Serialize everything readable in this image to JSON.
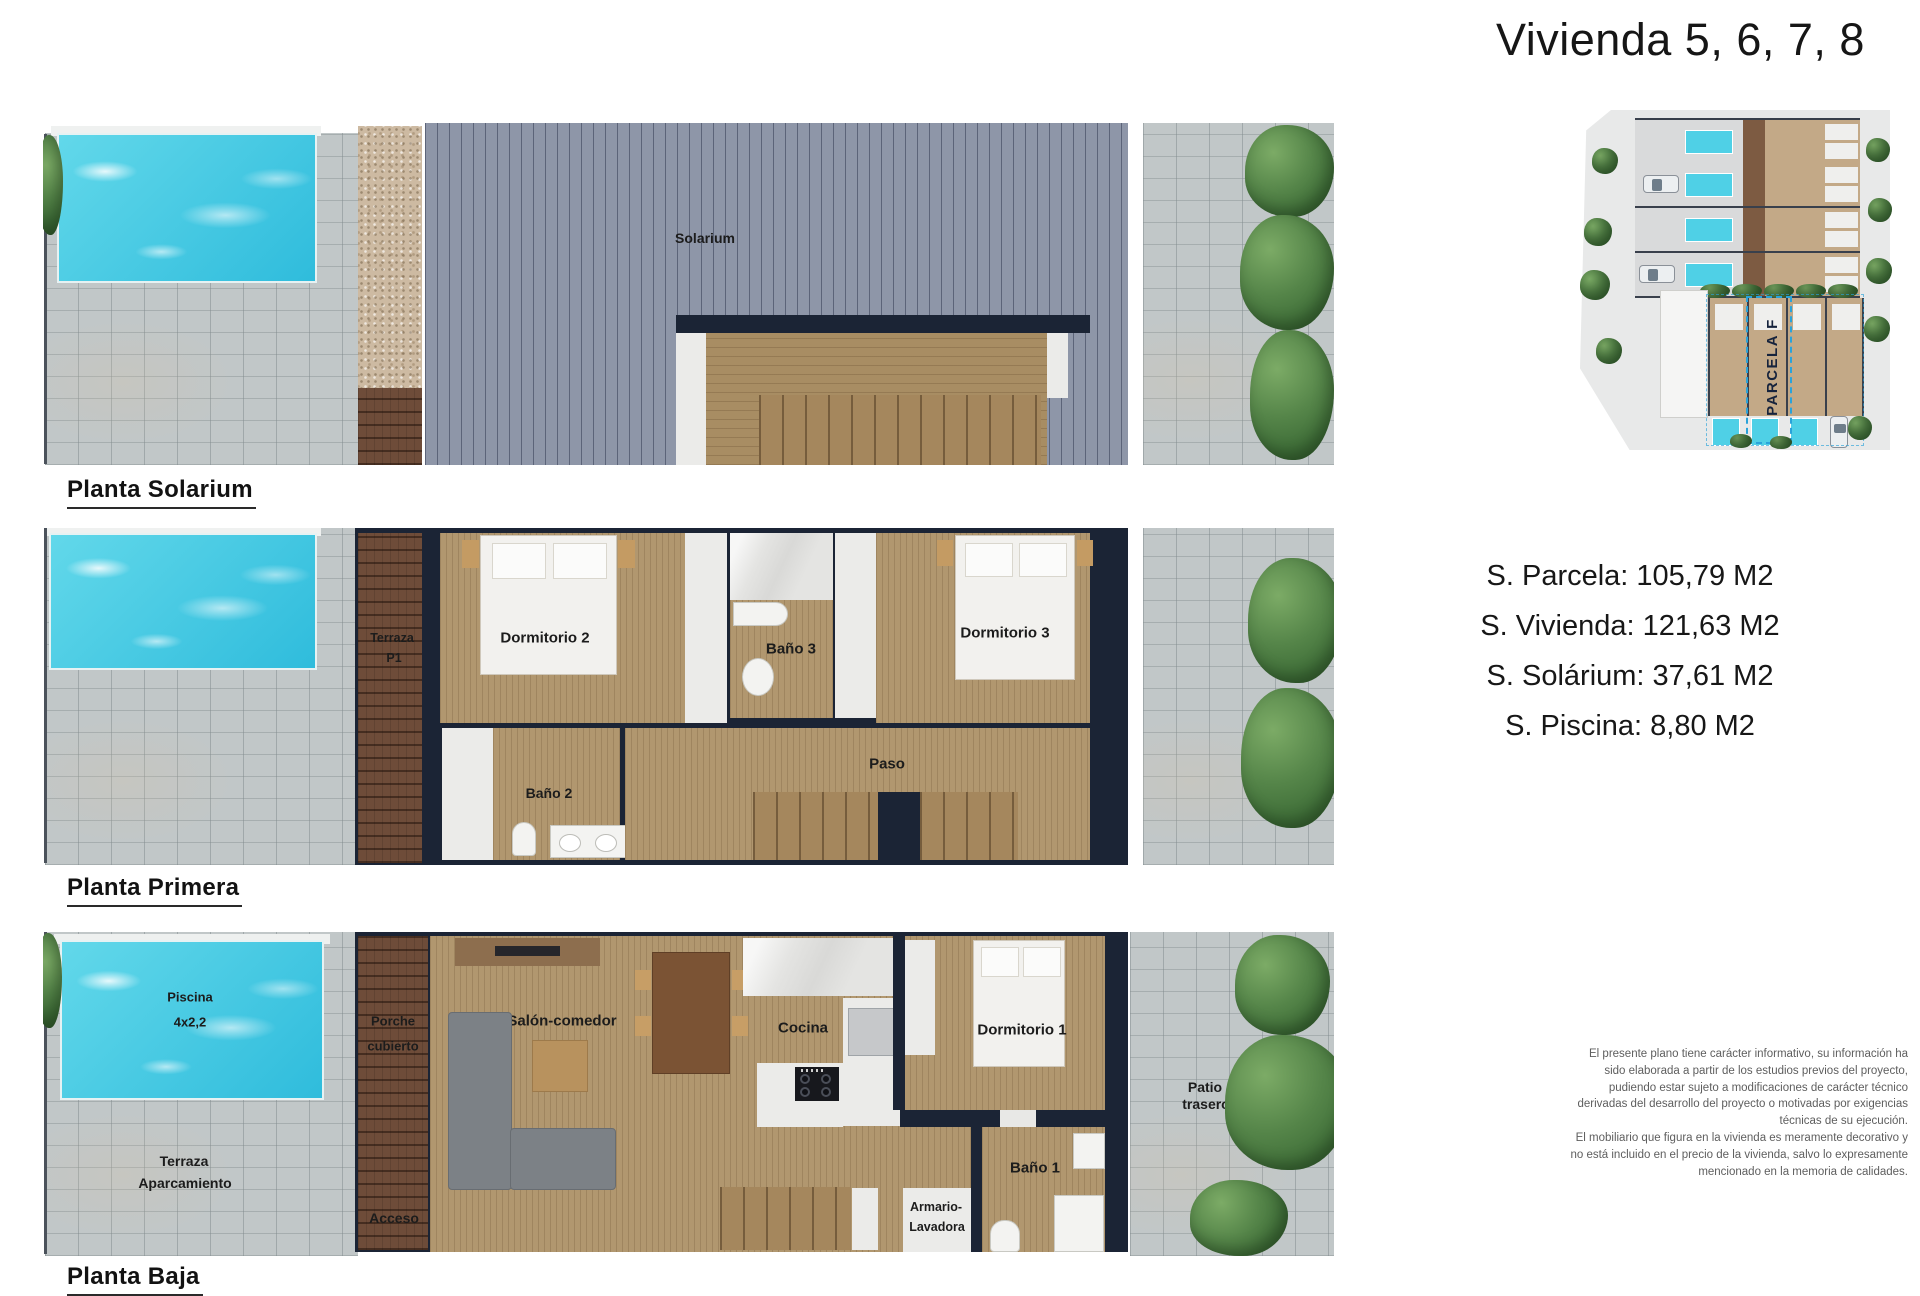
{
  "title": "Vivienda 5, 6, 7, 8",
  "plans": {
    "solarium": {
      "label": "Planta Solarium",
      "rooms": {
        "solarium": "Solarium"
      }
    },
    "primera": {
      "label": "Planta Primera",
      "rooms": {
        "terraza_l1": "Terraza",
        "terraza_l2": "P1",
        "dormitorio2": "Dormitorio 2",
        "bano3": "Baño 3",
        "dormitorio3": "Dormitorio 3",
        "bano2": "Baño 2",
        "paso": "Paso"
      }
    },
    "baja": {
      "label": "Planta Baja",
      "rooms": {
        "piscina_l1": "Piscina",
        "piscina_l2": "4x2,2",
        "terraza_l1": "Terraza",
        "terraza_l2": "Aparcamiento",
        "porche_l1": "Porche",
        "porche_l2": "cubierto",
        "acceso": "Acceso",
        "salon": "Salón-comedor",
        "cocina": "Cocina",
        "dormitorio1": "Dormitorio 1",
        "armario_l1": "Armario-",
        "armario_l2": "Lavadora",
        "bano1": "Baño 1",
        "patio_l1": "Patio",
        "patio_l2": "trasero"
      }
    }
  },
  "site_plan": {
    "parcela_label": "PARCELA F"
  },
  "measurements": [
    "S. Parcela: 105,79 M2",
    "S. Vivienda: 121,63 M2",
    "S. Solárium: 37,61 M2",
    "S. Piscina: 8,80 M2"
  ],
  "disclaimer": {
    "lines": [
      "El presente plano tiene carácter informativo, su información ha",
      "sido elaborada a partir de los estudios previos del proyecto,",
      "pudiendo estar sujeto a modificaciones de carácter técnico",
      "derivadas del desarrollo del proyecto o motivadas por exigencias",
      "técnicas de su ejecución.",
      "El mobiliario que figura en la vivienda es meramente decorativo y",
      "no está incluido en el precio de la vivienda, salvo lo expresamente",
      "mencionado en la memoria de calidades."
    ]
  },
  "colors": {
    "pool": "#41c9e3",
    "wall": "#1b2435",
    "wood_floor": "#b1976f",
    "dark_wood": "#6e4c39",
    "paving": "#c1c7c8",
    "solarium_deck": "#8e96a8",
    "tree": "#558549",
    "parcela_dash": "#2aa3da"
  }
}
